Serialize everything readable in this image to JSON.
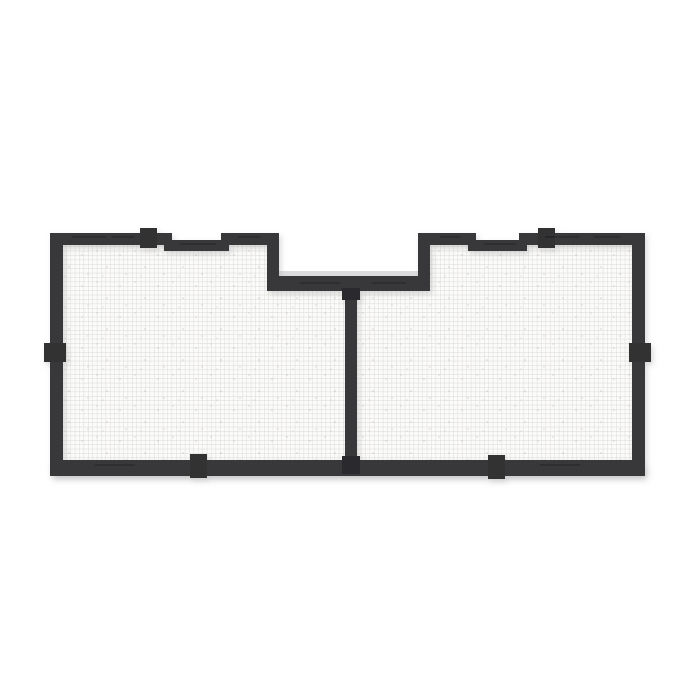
{
  "image": {
    "alt": "3D product render of a black-framed two-panel mesh vent screen with a notched top center, center divider bar and six mounting tabs, on a white background",
    "panel_count": 2,
    "tab_count": 6
  },
  "colors": {
    "background": "#ffffff",
    "frame": "#39393b",
    "frame_highlight": "#4a4a4d",
    "tab": "#303032",
    "foot": "#2c2c2e",
    "bevel": "#d9d9d9",
    "mesh_cell": "#fbfbfa",
    "mesh_line": "#dbd9d6",
    "mesh_speck": "#b5b2ad",
    "ground_shadow": "#c6c6c6",
    "streak": "#1f1f21"
  }
}
